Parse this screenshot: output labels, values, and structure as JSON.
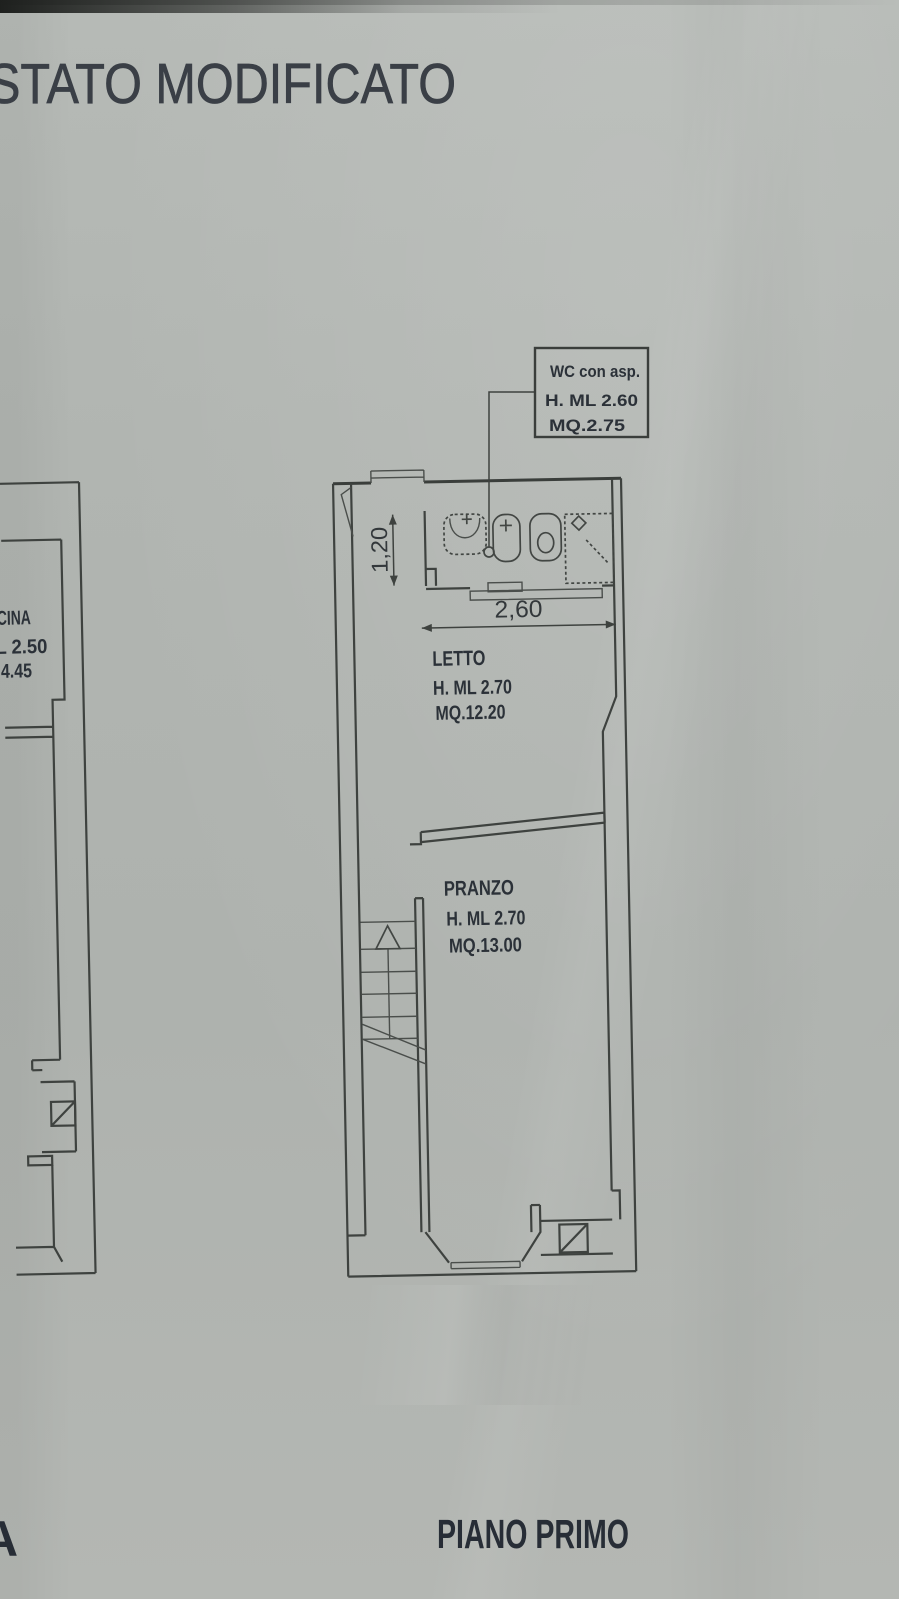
{
  "document": {
    "title": "STATO MODIFICATO",
    "floor_label": "PIANO PRIMO",
    "corner_partial_letter": "A"
  },
  "callout_wc": {
    "title": "WC con asp.",
    "ceiling_height": "H. ML 2.60",
    "area": "MQ.2.75"
  },
  "rooms": {
    "letto": {
      "name": "LETTO",
      "ceiling_height": "H. ML 2.70",
      "area": "MQ.12.20"
    },
    "pranzo": {
      "name": "PRANZO",
      "ceiling_height": "H. ML 2.70",
      "area": "MQ.13.00"
    },
    "adjacent_unit_partial": {
      "name": "CINA",
      "ceiling_height": "L 2.50",
      "area": "4.45"
    }
  },
  "dimensions": {
    "bathroom_depth_m": "1,20",
    "bathroom_width_m": "2,60"
  },
  "colors": {
    "paper": "#b1b5b1",
    "ink": "#3e423f",
    "label_text": "#2b3138",
    "title_text": "#3a3f46"
  }
}
